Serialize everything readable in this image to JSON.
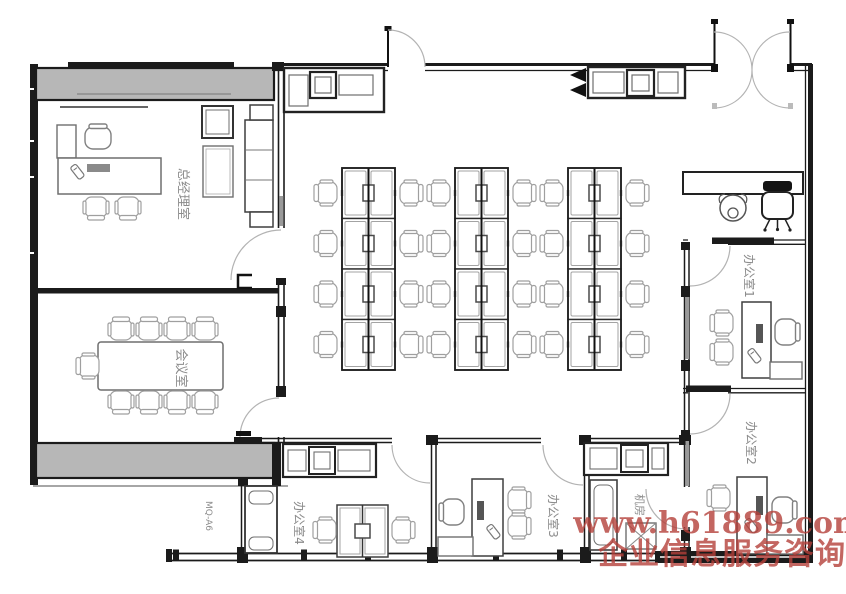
{
  "rooms": {
    "gm_office": {
      "label": "总经理室"
    },
    "meeting_room": {
      "label": "会议室"
    },
    "office1": {
      "label": "办公室1"
    },
    "office2": {
      "label": "办公室2"
    },
    "office3": {
      "label": "办公室3"
    },
    "office4": {
      "label": "办公室4"
    },
    "machine_room": {
      "label": "机房"
    }
  },
  "annotations": {
    "door_tag": "MQ-A6"
  },
  "watermark": {
    "line1": "www.h61889.com",
    "line2": "企业信息服务咨询"
  },
  "colors": {
    "wall": "#1b1b1b",
    "window-band": "#b7b7b7",
    "furniture-dark": "#3f3f3f",
    "furniture-light": "#9f9f9f",
    "label-text": "#8c8c8c",
    "watermark": "#b5403a",
    "background": "#ffffff"
  }
}
